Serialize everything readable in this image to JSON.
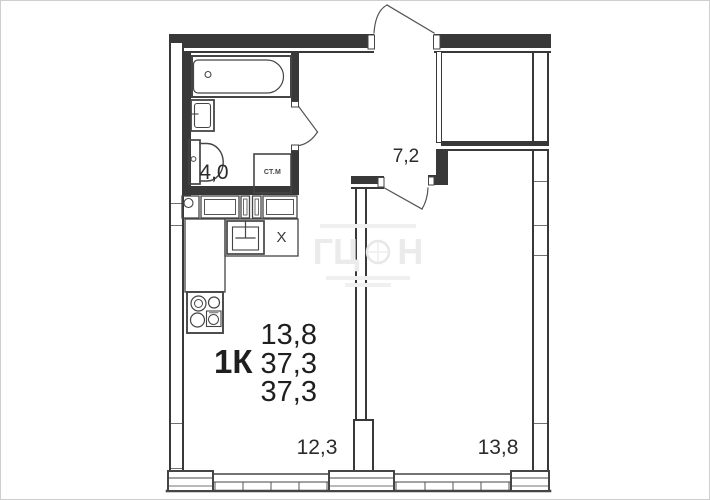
{
  "floor_plan": {
    "summary": {
      "area_top": "13,8",
      "type": "1К",
      "area_mid": "37,3",
      "area_bottom": "37,3"
    },
    "rooms": {
      "bathroom": {
        "area": "4,0"
      },
      "hallway": {
        "area": "7,2"
      },
      "kitchen_living": {
        "area": "12,3"
      },
      "bedroom": {
        "area": "13,8"
      }
    },
    "annotations": {
      "washing_machine": "СТ.М",
      "kitchen_x": "Х"
    },
    "colors": {
      "wall": "#383838",
      "fixture_line": "#454545",
      "text": "#2b2b2b",
      "watermark": "#ebebeb"
    }
  },
  "watermark": {
    "left": "ГЦ",
    "right": "Н"
  }
}
